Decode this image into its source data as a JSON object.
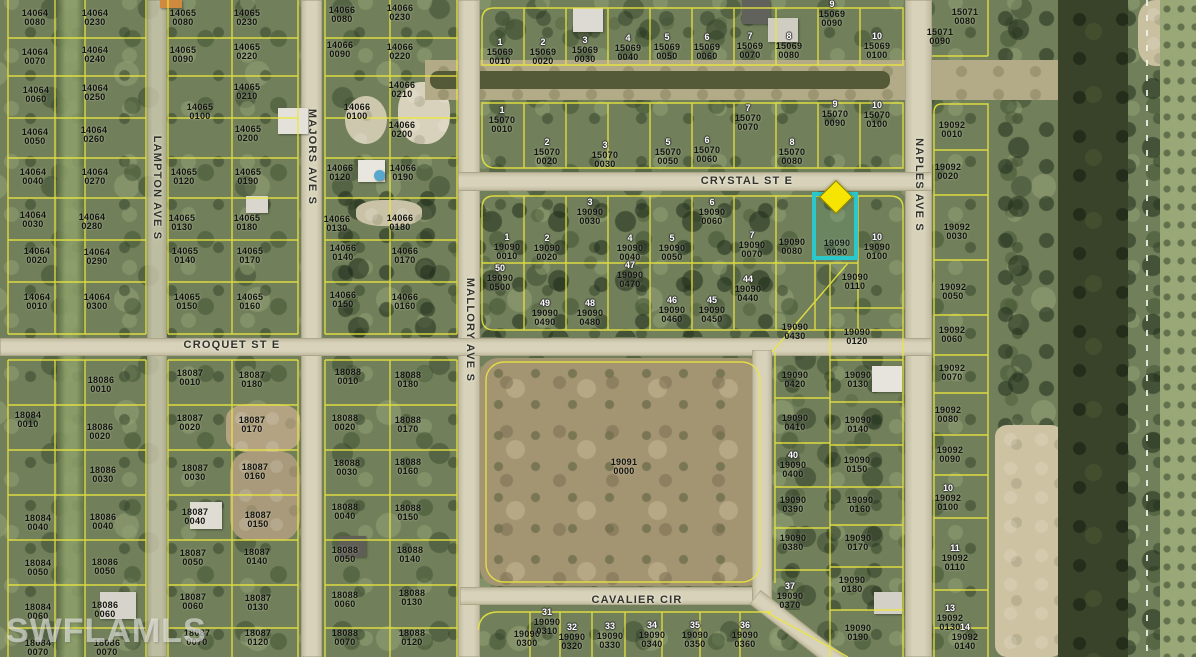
{
  "map": {
    "watermark": "SWFLAMLS",
    "highlight": {
      "parcel_id": "19090 0090",
      "outline_color": "#2bc7cb",
      "marker_color": "#f6e503"
    },
    "streets": [
      {
        "name": "CRYSTAL ST E",
        "x": 747,
        "y": 181,
        "vertical": false
      },
      {
        "name": "CROQUET ST E",
        "x": 232,
        "y": 345,
        "vertical": false
      },
      {
        "name": "CAVALIER CIR",
        "x": 637,
        "y": 600,
        "vertical": false
      },
      {
        "name": "LAMPTON AVE S",
        "x": 157,
        "y": 188,
        "vertical": true
      },
      {
        "name": "MAJORS AVE S",
        "x": 312,
        "y": 157,
        "vertical": true
      },
      {
        "name": "MALLORY AVE S",
        "x": 470,
        "y": 330,
        "vertical": true
      },
      {
        "name": "NAPLES AVE S",
        "x": 919,
        "y": 185,
        "vertical": true
      }
    ],
    "parcels": [
      {
        "id": "14064 0080",
        "x": 35,
        "y": 18
      },
      {
        "id": "14064 0230",
        "x": 95,
        "y": 18
      },
      {
        "id": "14064 0070",
        "x": 35,
        "y": 57
      },
      {
        "id": "14064 0240",
        "x": 95,
        "y": 55
      },
      {
        "id": "14064 0060",
        "x": 36,
        "y": 95
      },
      {
        "id": "14064 0250",
        "x": 95,
        "y": 93
      },
      {
        "id": "14064 0050",
        "x": 35,
        "y": 137
      },
      {
        "id": "14064 0260",
        "x": 94,
        "y": 135
      },
      {
        "id": "14064 0040",
        "x": 33,
        "y": 177
      },
      {
        "id": "14064 0270",
        "x": 95,
        "y": 177
      },
      {
        "id": "14064 0030",
        "x": 33,
        "y": 220
      },
      {
        "id": "14064 0280",
        "x": 92,
        "y": 222
      },
      {
        "id": "14064 0020",
        "x": 37,
        "y": 256
      },
      {
        "id": "14064 0290",
        "x": 97,
        "y": 257
      },
      {
        "id": "14064 0010",
        "x": 37,
        "y": 302
      },
      {
        "id": "14064 0300",
        "x": 97,
        "y": 302
      },
      {
        "id": "14065 0080",
        "x": 183,
        "y": 18
      },
      {
        "id": "14065 0230",
        "x": 247,
        "y": 18
      },
      {
        "id": "14065 0090",
        "x": 183,
        "y": 55
      },
      {
        "id": "14065 0220",
        "x": 247,
        "y": 52
      },
      {
        "id": "14065 0100",
        "x": 200,
        "y": 112
      },
      {
        "id": "14065 0210",
        "x": 247,
        "y": 92
      },
      {
        "id": "14065 0200",
        "x": 248,
        "y": 134
      },
      {
        "id": "14065 0120",
        "x": 184,
        "y": 177
      },
      {
        "id": "14065 0190",
        "x": 248,
        "y": 177
      },
      {
        "id": "14065 0130",
        "x": 182,
        "y": 223
      },
      {
        "id": "14065 0180",
        "x": 247,
        "y": 223
      },
      {
        "id": "14065 0140",
        "x": 185,
        "y": 256
      },
      {
        "id": "14065 0170",
        "x": 250,
        "y": 256
      },
      {
        "id": "14065 0150",
        "x": 187,
        "y": 302
      },
      {
        "id": "14065 0160",
        "x": 250,
        "y": 302
      },
      {
        "id": "14066 0080",
        "x": 342,
        "y": 15
      },
      {
        "id": "14066 0230",
        "x": 400,
        "y": 13
      },
      {
        "id": "14066 0090",
        "x": 340,
        "y": 50
      },
      {
        "id": "14066 0220",
        "x": 400,
        "y": 52
      },
      {
        "id": "14066 0100",
        "x": 357,
        "y": 112
      },
      {
        "id": "14066 0210",
        "x": 402,
        "y": 90
      },
      {
        "id": "14066 0200",
        "x": 402,
        "y": 130
      },
      {
        "id": "14066 0120",
        "x": 340,
        "y": 173
      },
      {
        "id": "14066 0190",
        "x": 403,
        "y": 173
      },
      {
        "id": "14066 0130",
        "x": 337,
        "y": 224
      },
      {
        "id": "14066 0180",
        "x": 400,
        "y": 223
      },
      {
        "id": "14066 0140",
        "x": 343,
        "y": 253
      },
      {
        "id": "14066 0170",
        "x": 405,
        "y": 256
      },
      {
        "id": "14066 0150",
        "x": 343,
        "y": 300
      },
      {
        "id": "14066 0160",
        "x": 405,
        "y": 302
      },
      {
        "id": "15069 0010",
        "x": 500,
        "y": 52,
        "lot": "1"
      },
      {
        "id": "15069 0020",
        "x": 543,
        "y": 52,
        "lot": "2"
      },
      {
        "id": "15069 0030",
        "x": 585,
        "y": 50,
        "lot": "3"
      },
      {
        "id": "15069 0040",
        "x": 628,
        "y": 48,
        "lot": "4"
      },
      {
        "id": "15069 0050",
        "x": 667,
        "y": 47,
        "lot": "5"
      },
      {
        "id": "15069 0060",
        "x": 707,
        "y": 47,
        "lot": "6"
      },
      {
        "id": "15069 0070",
        "x": 750,
        "y": 46,
        "lot": "7"
      },
      {
        "id": "15069 0080",
        "x": 789,
        "y": 46,
        "lot": "8"
      },
      {
        "id": "15069 0090",
        "x": 832,
        "y": 14,
        "lot": "9"
      },
      {
        "id": "15069 0100",
        "x": 877,
        "y": 46,
        "lot": "10"
      },
      {
        "id": "15070 0010",
        "x": 502,
        "y": 120,
        "lot": "1"
      },
      {
        "id": "15070 0020",
        "x": 547,
        "y": 152,
        "lot": "2"
      },
      {
        "id": "15070 0030",
        "x": 605,
        "y": 155,
        "lot": "3"
      },
      {
        "id": "15070 0050",
        "x": 668,
        "y": 152,
        "lot": "5"
      },
      {
        "id": "15070 0060",
        "x": 707,
        "y": 150,
        "lot": "6"
      },
      {
        "id": "15070 0070",
        "x": 748,
        "y": 118,
        "lot": "7"
      },
      {
        "id": "15070 0080",
        "x": 792,
        "y": 152,
        "lot": "8"
      },
      {
        "id": "15070 0090",
        "x": 835,
        "y": 114,
        "lot": "9"
      },
      {
        "id": "15070 0100",
        "x": 877,
        "y": 115,
        "lot": "10"
      },
      {
        "id": "15071 0080",
        "x": 965,
        "y": 17
      },
      {
        "id": "15071 0090",
        "x": 940,
        "y": 37
      },
      {
        "id": "19092 0010",
        "x": 952,
        "y": 130
      },
      {
        "id": "19092 0020",
        "x": 948,
        "y": 172
      },
      {
        "id": "19092 0030",
        "x": 957,
        "y": 232
      },
      {
        "id": "19092 0050",
        "x": 953,
        "y": 292
      },
      {
        "id": "19092 0060",
        "x": 952,
        "y": 335
      },
      {
        "id": "19092 0070",
        "x": 952,
        "y": 373
      },
      {
        "id": "19092 0080",
        "x": 948,
        "y": 415
      },
      {
        "id": "19092 0090",
        "x": 950,
        "y": 455
      },
      {
        "id": "19092 0100",
        "x": 948,
        "y": 498,
        "lot": "10"
      },
      {
        "id": "19092 0110",
        "x": 955,
        "y": 558,
        "lot": "11"
      },
      {
        "id": "19092 0130",
        "x": 950,
        "y": 618,
        "lot": "13"
      },
      {
        "id": "19092 0140",
        "x": 965,
        "y": 637,
        "lot": "14"
      },
      {
        "id": "19090 0010",
        "x": 507,
        "y": 247,
        "lot": "1"
      },
      {
        "id": "19090 0020",
        "x": 547,
        "y": 248,
        "lot": "2"
      },
      {
        "id": "19090 0030",
        "x": 590,
        "y": 212,
        "lot": "3"
      },
      {
        "id": "19090 0040",
        "x": 630,
        "y": 248,
        "lot": "4"
      },
      {
        "id": "19090 0050",
        "x": 672,
        "y": 248,
        "lot": "5"
      },
      {
        "id": "19090 0060",
        "x": 712,
        "y": 212,
        "lot": "6"
      },
      {
        "id": "19090 0070",
        "x": 752,
        "y": 245,
        "lot": "7"
      },
      {
        "id": "19090 0080",
        "x": 792,
        "y": 247
      },
      {
        "id": "19090 0090",
        "x": 837,
        "y": 248
      },
      {
        "id": "19090 0100",
        "x": 877,
        "y": 247,
        "lot": "10"
      },
      {
        "id": "19090 0500",
        "x": 500,
        "y": 278,
        "lot": "50"
      },
      {
        "id": "19090 0490",
        "x": 545,
        "y": 313,
        "lot": "49"
      },
      {
        "id": "19090 0480",
        "x": 590,
        "y": 313,
        "lot": "48"
      },
      {
        "id": "19090 0470",
        "x": 630,
        "y": 275,
        "lot": "47"
      },
      {
        "id": "19090 0460",
        "x": 672,
        "y": 310,
        "lot": "46"
      },
      {
        "id": "19090 0450",
        "x": 712,
        "y": 310,
        "lot": "45"
      },
      {
        "id": "19090 0440",
        "x": 748,
        "y": 289,
        "lot": "44"
      },
      {
        "id": "19090 0110",
        "x": 855,
        "y": 282
      },
      {
        "id": "19090 0430",
        "x": 795,
        "y": 332
      },
      {
        "id": "19090 0120",
        "x": 857,
        "y": 337
      },
      {
        "id": "19090 0130",
        "x": 858,
        "y": 380
      },
      {
        "id": "19090 0420",
        "x": 795,
        "y": 380
      },
      {
        "id": "19090 0410",
        "x": 795,
        "y": 423
      },
      {
        "id": "19090 0140",
        "x": 858,
        "y": 425
      },
      {
        "id": "19090 0400",
        "x": 793,
        "y": 465,
        "lot": "40"
      },
      {
        "id": "19090 0150",
        "x": 857,
        "y": 465
      },
      {
        "id": "19090 0390",
        "x": 793,
        "y": 505
      },
      {
        "id": "19090 0160",
        "x": 860,
        "y": 505
      },
      {
        "id": "19090 0380",
        "x": 793,
        "y": 543
      },
      {
        "id": "19090 0170",
        "x": 858,
        "y": 543
      },
      {
        "id": "19090 0370",
        "x": 790,
        "y": 596,
        "lot": "37"
      },
      {
        "id": "19090 0180",
        "x": 852,
        "y": 585
      },
      {
        "id": "19090 0190",
        "x": 858,
        "y": 633
      },
      {
        "id": "19090 0300",
        "x": 527,
        "y": 639
      },
      {
        "id": "19090 0310",
        "x": 547,
        "y": 622,
        "lot": "31"
      },
      {
        "id": "19090 0320",
        "x": 572,
        "y": 637,
        "lot": "32"
      },
      {
        "id": "19090 0330",
        "x": 610,
        "y": 636,
        "lot": "33"
      },
      {
        "id": "19090 0340",
        "x": 652,
        "y": 635,
        "lot": "34"
      },
      {
        "id": "19090 0350",
        "x": 695,
        "y": 635,
        "lot": "35"
      },
      {
        "id": "19090 0360",
        "x": 745,
        "y": 635,
        "lot": "36"
      },
      {
        "id": "19091 0000",
        "x": 624,
        "y": 467
      },
      {
        "id": "18084 0010",
        "x": 28,
        "y": 420
      },
      {
        "id": "18084 0040",
        "x": 38,
        "y": 523
      },
      {
        "id": "18084 0050",
        "x": 38,
        "y": 568
      },
      {
        "id": "18084 0060",
        "x": 38,
        "y": 612
      },
      {
        "id": "18084 0070",
        "x": 38,
        "y": 648
      },
      {
        "id": "18086 0010",
        "x": 101,
        "y": 385
      },
      {
        "id": "18086 0020",
        "x": 100,
        "y": 432
      },
      {
        "id": "18086 0030",
        "x": 103,
        "y": 475
      },
      {
        "id": "18086 0040",
        "x": 103,
        "y": 522
      },
      {
        "id": "18086 0050",
        "x": 105,
        "y": 567
      },
      {
        "id": "18086 0060",
        "x": 105,
        "y": 610
      },
      {
        "id": "18086 0070",
        "x": 107,
        "y": 648
      },
      {
        "id": "18087 0010",
        "x": 190,
        "y": 378
      },
      {
        "id": "18087 0180",
        "x": 252,
        "y": 380
      },
      {
        "id": "18087 0020",
        "x": 190,
        "y": 423
      },
      {
        "id": "18087 0170",
        "x": 252,
        "y": 425
      },
      {
        "id": "18087 0030",
        "x": 195,
        "y": 473
      },
      {
        "id": "18087 0160",
        "x": 255,
        "y": 472
      },
      {
        "id": "18087 0040",
        "x": 195,
        "y": 517
      },
      {
        "id": "18087 0150",
        "x": 258,
        "y": 520
      },
      {
        "id": "18087 0050",
        "x": 193,
        "y": 558
      },
      {
        "id": "18087 0140",
        "x": 257,
        "y": 557
      },
      {
        "id": "18087 0060",
        "x": 193,
        "y": 602
      },
      {
        "id": "18087 0130",
        "x": 258,
        "y": 603
      },
      {
        "id": "18087 0070",
        "x": 197,
        "y": 638
      },
      {
        "id": "18087 0120",
        "x": 258,
        "y": 638
      },
      {
        "id": "18088 0010",
        "x": 348,
        "y": 377
      },
      {
        "id": "18088 0180",
        "x": 408,
        "y": 380
      },
      {
        "id": "18088 0020",
        "x": 345,
        "y": 423
      },
      {
        "id": "18088 0170",
        "x": 408,
        "y": 425
      },
      {
        "id": "18088 0030",
        "x": 347,
        "y": 468
      },
      {
        "id": "18088 0160",
        "x": 408,
        "y": 467
      },
      {
        "id": "18088 0040",
        "x": 345,
        "y": 512
      },
      {
        "id": "18088 0150",
        "x": 408,
        "y": 513
      },
      {
        "id": "18088 0050",
        "x": 345,
        "y": 555
      },
      {
        "id": "18088 0140",
        "x": 410,
        "y": 555
      },
      {
        "id": "18088 0060",
        "x": 345,
        "y": 600
      },
      {
        "id": "18088 0130",
        "x": 412,
        "y": 598
      },
      {
        "id": "18088 0070",
        "x": 345,
        "y": 638
      },
      {
        "id": "18088 0120",
        "x": 412,
        "y": 638
      }
    ],
    "buildings": [
      {
        "x": 573,
        "y": 8,
        "w": 30,
        "h": 24,
        "c": "#dcdad2"
      },
      {
        "x": 742,
        "y": 0,
        "w": 28,
        "h": 24,
        "c": "#62625c"
      },
      {
        "x": 768,
        "y": 18,
        "w": 30,
        "h": 24,
        "c": "#cfccc2"
      },
      {
        "x": 278,
        "y": 108,
        "w": 30,
        "h": 26,
        "c": "#e3e1d9"
      },
      {
        "x": 358,
        "y": 160,
        "w": 27,
        "h": 22,
        "c": "#e8e6de"
      },
      {
        "x": 374,
        "y": 170,
        "w": 11,
        "h": 11,
        "c": "#57a8cc",
        "round": true
      },
      {
        "x": 246,
        "y": 196,
        "w": 22,
        "h": 17,
        "c": "#d9d7cd"
      },
      {
        "x": 190,
        "y": 502,
        "w": 32,
        "h": 27,
        "c": "#dedcd3"
      },
      {
        "x": 100,
        "y": 592,
        "w": 36,
        "h": 27,
        "c": "#d6d4ca"
      },
      {
        "x": 338,
        "y": 536,
        "w": 28,
        "h": 21,
        "c": "#5f5e56"
      },
      {
        "x": 872,
        "y": 366,
        "w": 30,
        "h": 26,
        "c": "#e6e4dc"
      },
      {
        "x": 874,
        "y": 592,
        "w": 28,
        "h": 22,
        "c": "#d2d0c7"
      },
      {
        "x": 160,
        "y": 0,
        "w": 22,
        "h": 8,
        "c": "#cf8a3f"
      }
    ],
    "colors": {
      "parcel_line": "#ece73e",
      "road": "#d7d2b9",
      "canal_water": "#39432a",
      "vegetation": "#71805a",
      "field": "#a39472"
    }
  }
}
